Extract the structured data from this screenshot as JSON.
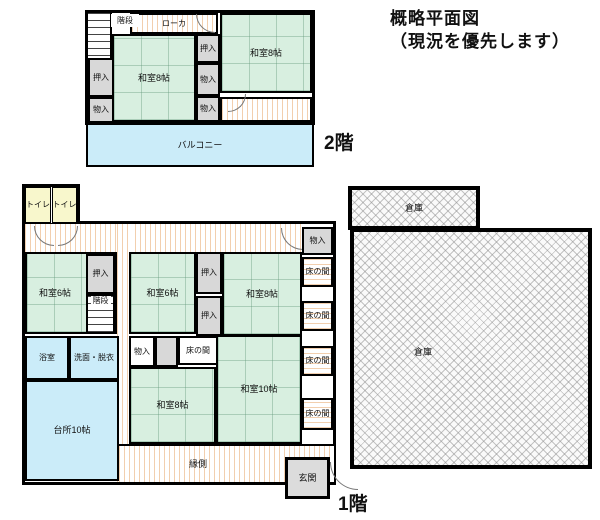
{
  "title": {
    "line1": "概略平面図",
    "line2": "（現況を優先します）"
  },
  "floor2": {
    "label": "2階",
    "rooms": {
      "stairs": "階段",
      "corridor": "ローカ",
      "washitsu_left": "和室8帖",
      "washitsu_right": "和室8帖",
      "oshiire_left": "押入",
      "monoire_left": "物入",
      "oshiire_mid": "押入",
      "monoire_mid1": "物入",
      "monoire_mid2": "物入",
      "balcony": "バルコニー"
    }
  },
  "floor1": {
    "label": "1階",
    "rooms": {
      "toilet_left": "トイレ",
      "toilet_right": "トイレ",
      "monoire_top": "物入",
      "washitsu6_left": "和室6帖",
      "oshiire_left": "押入",
      "stairs": "階段",
      "washitsu6_mid": "和室6帖",
      "oshiire_mid_upper": "押入",
      "oshiire_mid_lower": "押入",
      "washitsu8_upper": "和室8帖",
      "tokonoma_1": "床の間",
      "tokonoma_2": "床の間",
      "tokonoma_3": "床の間",
      "tokonoma_4": "床の間",
      "bathroom": "浴室",
      "washroom": "洗面・脱衣",
      "kitchen": "台所10帖",
      "monoire_mid": "物入",
      "tokonoma_mid": "床の間",
      "washitsu8_lower": "和室8帖",
      "washitsu10": "和室10帖",
      "engawa": "縁側",
      "genkan": "玄関"
    }
  },
  "warehouse": {
    "upper": "倉庫",
    "main": "倉庫"
  },
  "colors": {
    "tatami_green": "#d8efe0",
    "water_cyan": "#cbecf9",
    "toilet_yellow": "#f8f7cc",
    "closet_gray": "#d8d8d8",
    "wood_hatch": "#f2cfae",
    "wall": "#000000"
  }
}
